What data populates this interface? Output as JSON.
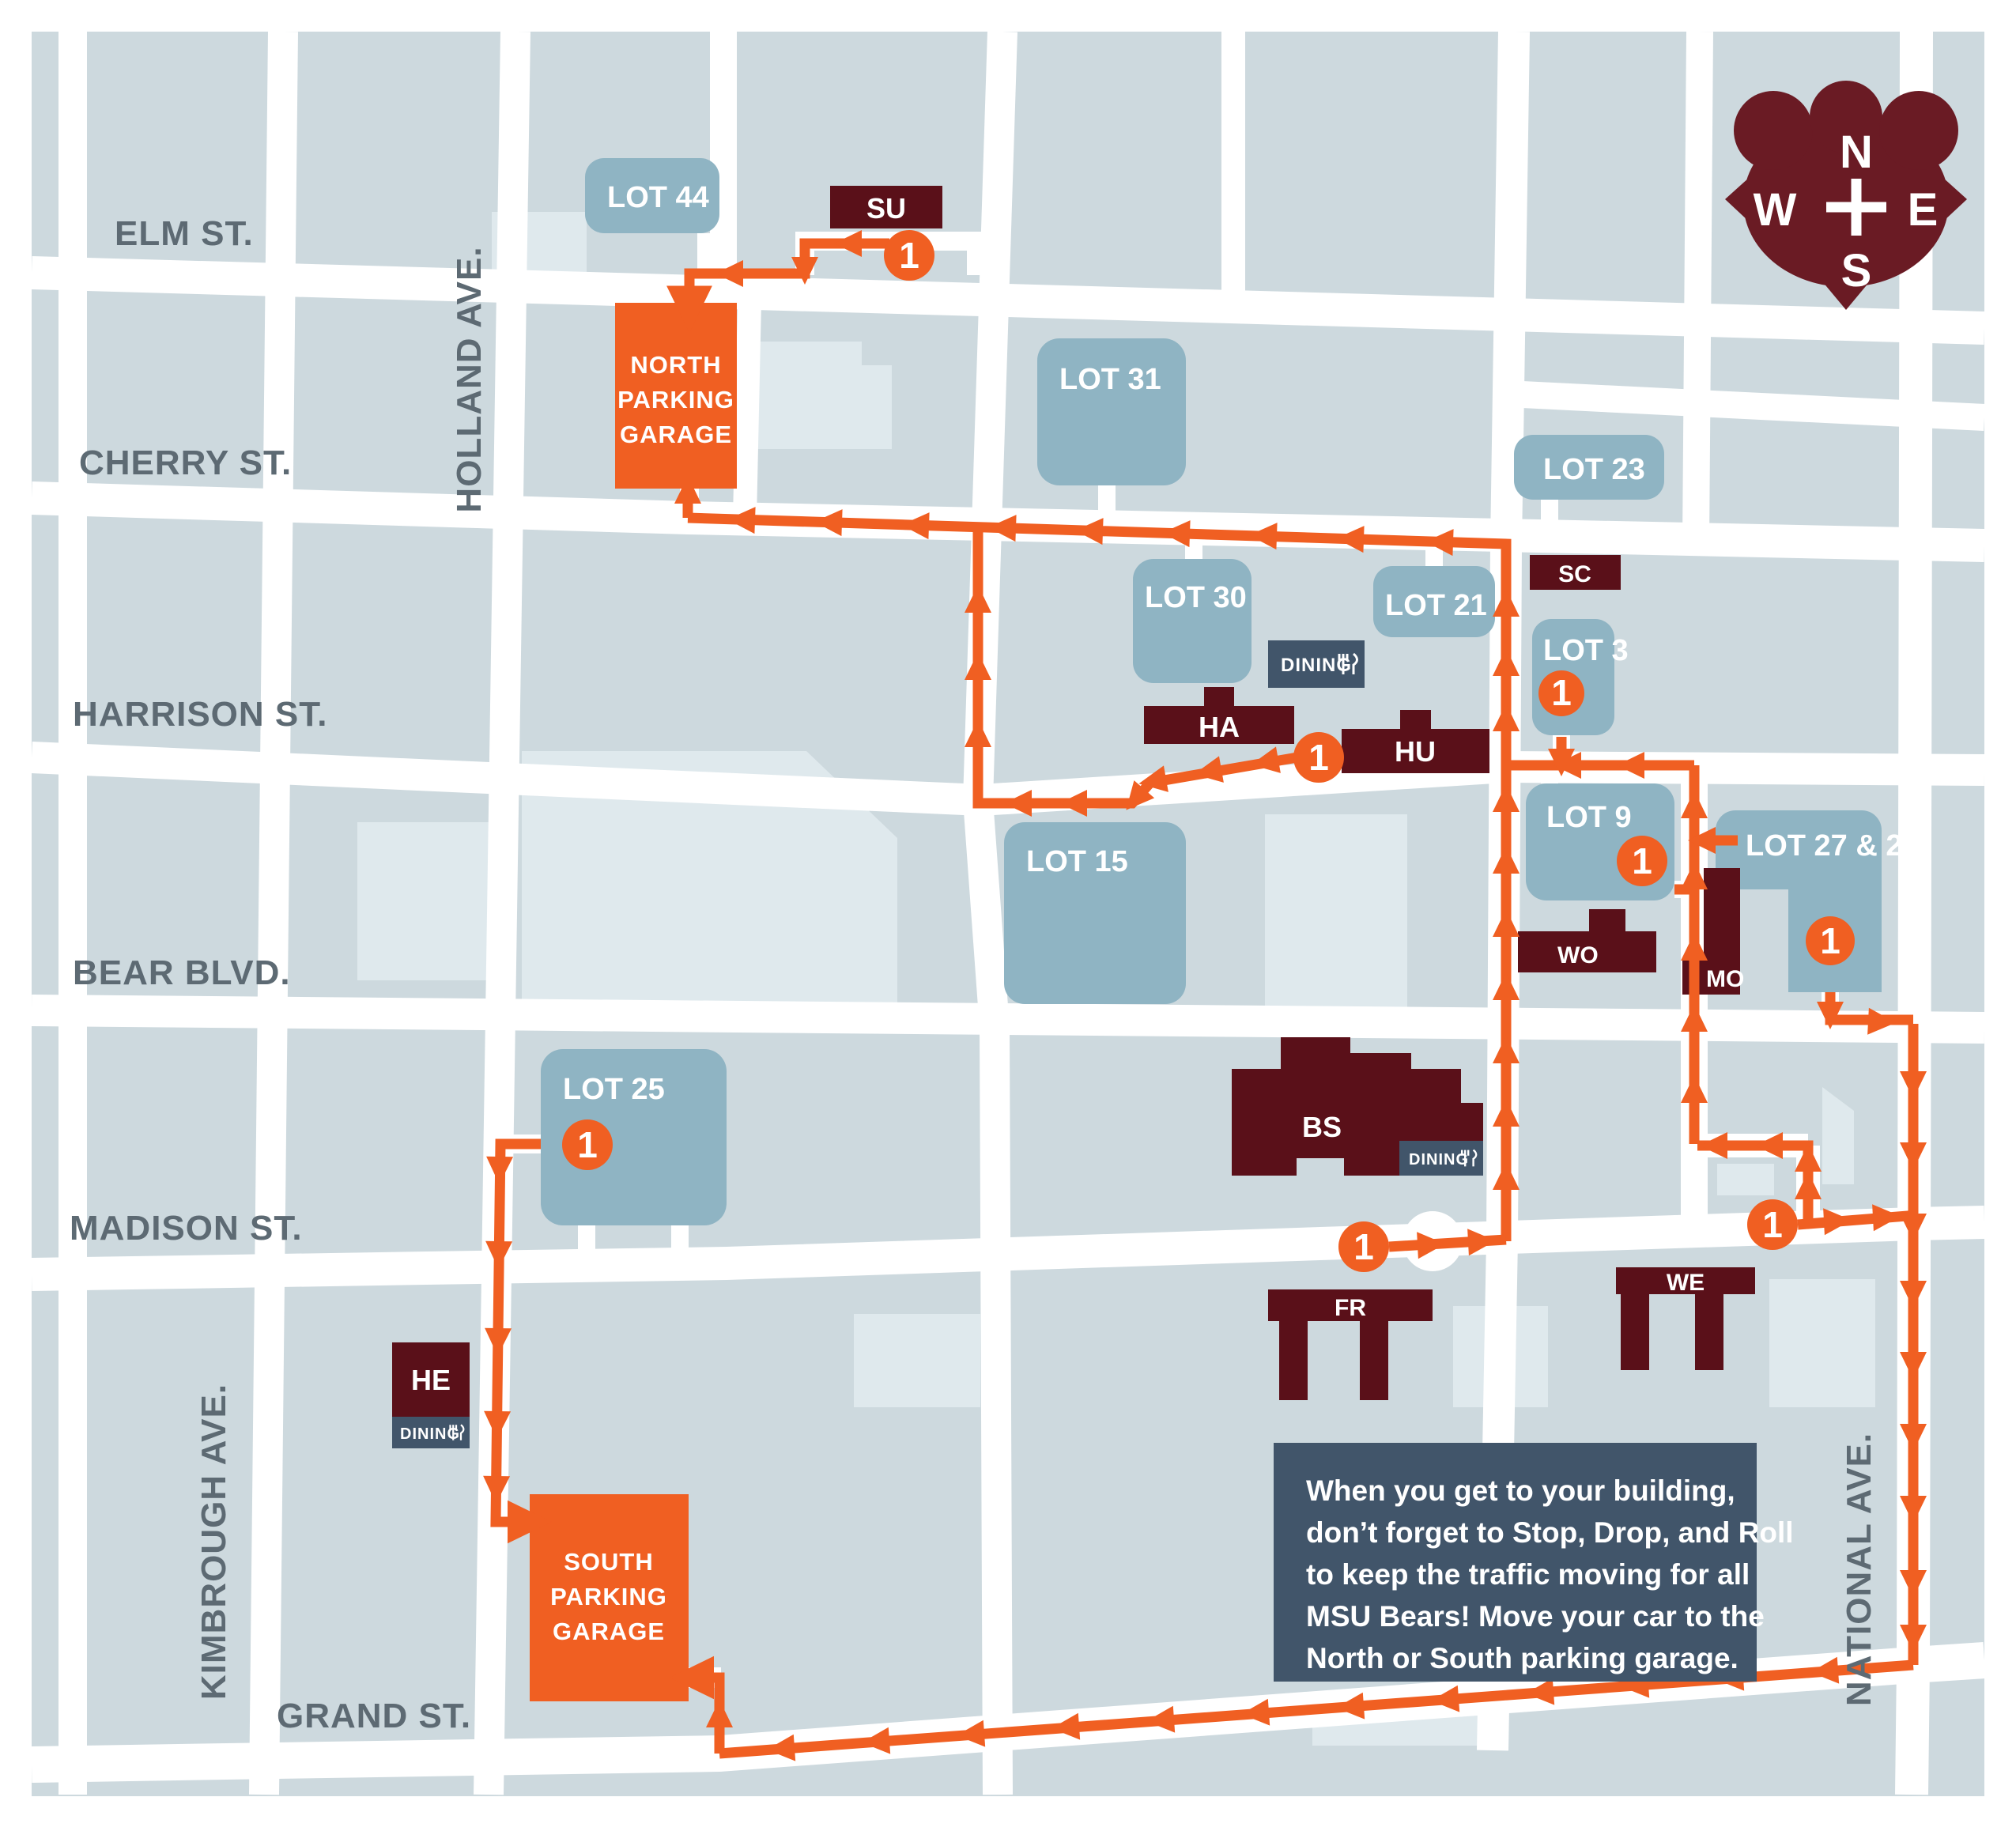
{
  "map": {
    "colors": {
      "block": "#cdd9de",
      "street": "#ffffff",
      "lot_blue": "#8fb4c3",
      "building_maroon": "#5a1019",
      "compass_maroon": "#6a1b24",
      "route_orange": "#f05f22",
      "badge_navy": "#41556a",
      "street_label_gray": "#5d6a73",
      "footprint_light": "#dfe9ed"
    },
    "compass": {
      "n": "N",
      "e": "E",
      "w": "W",
      "s": "S"
    },
    "streets": {
      "elm": "ELM ST.",
      "cherry": "CHERRY ST.",
      "harrison": "HARRISON ST.",
      "bear": "BEAR BLVD.",
      "madison": "MADISON ST.",
      "grand": "GRAND ST.",
      "holland": "HOLLAND AVE.",
      "kimbrough": "KIMBROUGH AVE.",
      "national": "NATIONAL AVE."
    },
    "lots": {
      "lot44": "LOT 44",
      "lot31": "LOT 31",
      "lot23": "LOT 23",
      "lot30": "LOT 30",
      "lot21": "LOT 21",
      "lot3": "LOT 3",
      "lot9": "LOT 9",
      "lot2729": "LOT 27 & 29",
      "lot15": "LOT 15",
      "lot25": "LOT 25"
    },
    "buildings": {
      "su": "SU",
      "sc": "SC",
      "ha": "HA",
      "hu": "HU",
      "wo": "WO",
      "mo": "MO",
      "bs": "BS",
      "fr": "FR",
      "we": "WE",
      "he": "HE"
    },
    "garages": {
      "north": {
        "lines": [
          "NORTH",
          "PARKING",
          "GARAGE"
        ]
      },
      "south": {
        "lines": [
          "SOUTH",
          "PARKING",
          "GARAGE"
        ]
      }
    },
    "dining_label": "DINING",
    "marker": "1",
    "info": {
      "lines": [
        "When you get to your building,",
        "don’t forget to Stop, Drop, and Roll",
        "to keep the traffic moving for all",
        "MSU Bears! Move your car to the",
        "North or South parking garage."
      ]
    }
  }
}
